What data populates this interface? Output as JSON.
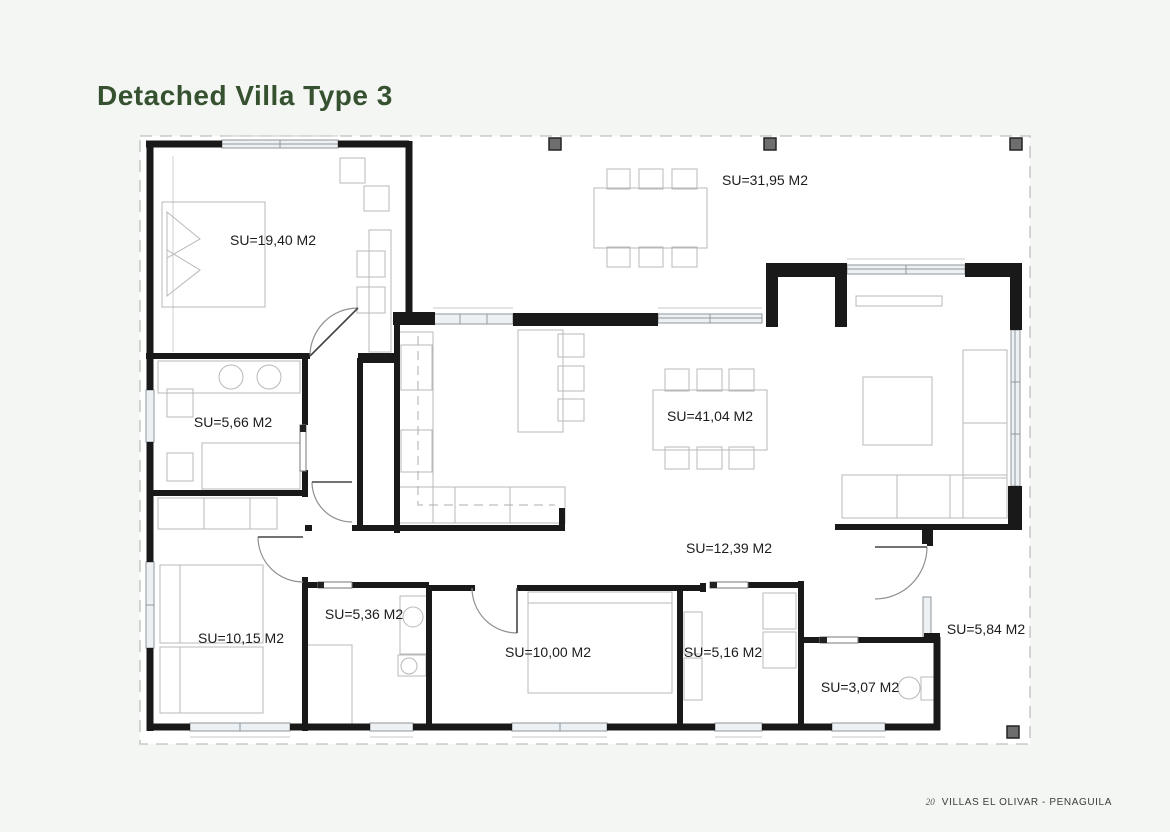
{
  "page": {
    "title": "Detached Villa Type 3",
    "accent": "#35512f",
    "background": "#f4f6f3",
    "footer": {
      "page_number": "20",
      "project": "VILLAS EL OLIVAR - PENAGUILA"
    }
  },
  "floorplan": {
    "area_unit": "M2",
    "rooms": [
      {
        "id": "master-bedroom",
        "label": "SU=19,40 M2"
      },
      {
        "id": "terrace",
        "label": "SU=31,95 M2"
      },
      {
        "id": "bathroom-1",
        "label": "SU=5,66 M2"
      },
      {
        "id": "living-dining-kitchen",
        "label": "SU=41,04 M2"
      },
      {
        "id": "hallway",
        "label": "SU=12,39 M2"
      },
      {
        "id": "bedroom-2",
        "label": "SU=10,15 M2"
      },
      {
        "id": "bathroom-2",
        "label": "SU=5,36 M2"
      },
      {
        "id": "bedroom-3",
        "label": "SU=10,00 M2"
      },
      {
        "id": "utility-room",
        "label": "SU=5,16 M2"
      },
      {
        "id": "wc",
        "label": "SU=3,07 M2"
      },
      {
        "id": "entrance-porch",
        "label": "SU=5,84 M2"
      }
    ]
  }
}
